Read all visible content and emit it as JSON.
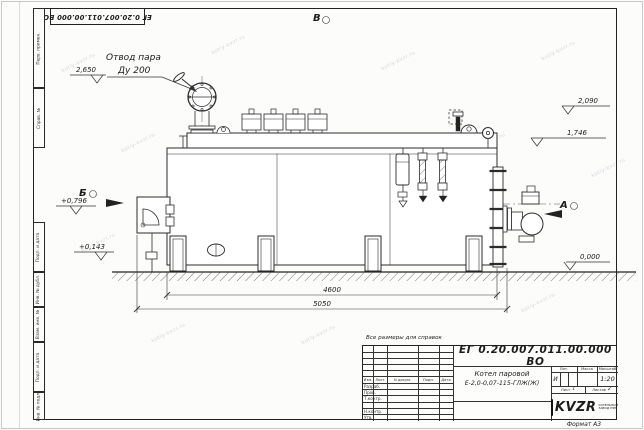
{
  "watermark": {
    "text": "kotly-kvzr.ru"
  },
  "stamp_top": {
    "doc_number": "ЕГ 0.20.007.011.00.000  ВО"
  },
  "margin_columns": [
    "Перв. примен.",
    "Справ. №",
    "Подп. и дата",
    "Инв. № дубл.",
    "Взам. инв. №",
    "Подп. и дата",
    "Инв. № подл."
  ],
  "note": "Все размеры для справок",
  "drawing": {
    "callout_line1": "Отвод пара",
    "callout_line2": "Ду 200",
    "view_top": "В",
    "view_left": "Б",
    "view_right": "А",
    "elev_steam": "2,650",
    "elev_right_upper": "2,090",
    "elev_right_lower": "1,746",
    "elev_left_upper": "+0,796",
    "elev_left_lower": "+0,143",
    "elev_ground": "0,000",
    "dim_inner": "4600",
    "dim_outer": "5050"
  },
  "title_block": {
    "doc_number": "ЕГ 0.20.007.011.00.000  ВО",
    "name_line1": "Котел паровой",
    "name_line2": "Е-2,0-0,07-115-ГЛЖ(Ж)",
    "col_izm": "Изм.",
    "col_list": "Лист",
    "col_doc": "N докум.",
    "col_podp": "Подп.",
    "col_data": "Дата",
    "row_razrab": "Разраб.",
    "row_prov": "Пров.",
    "row_tkontr": "Т.контр.",
    "row_nkontr": "Н.контр.",
    "row_utv": "Утв.",
    "lit_label": "Лит.",
    "mass_label": "Масса",
    "scale_label": "Масштаб",
    "lit_value": "И",
    "scale_value": "1:20",
    "sheet_label": "Лист",
    "sheet_num": "1",
    "sheets_label": "Листов",
    "sheets_num": "2",
    "brand": "KVZR",
    "brand_line1": "КОТЕЛЬНЫЙ",
    "brand_line2": "ЗАВОД РЭП",
    "format": "Формат А3"
  }
}
